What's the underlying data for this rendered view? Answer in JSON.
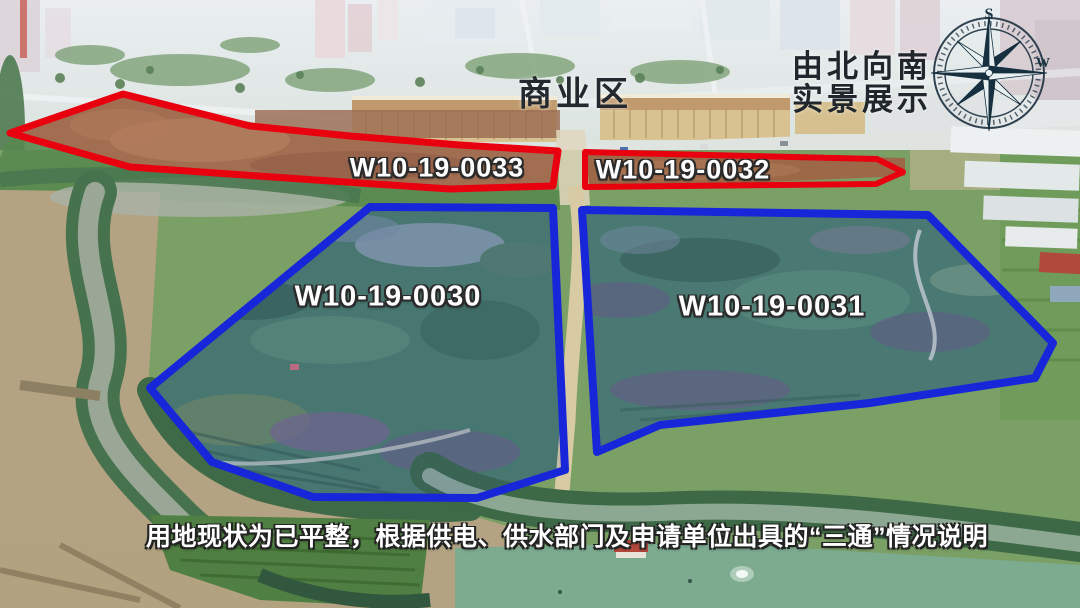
{
  "scene": {
    "type": "annotated-aerial-photo",
    "zone_label": "商业区",
    "view_label_line1": "由北向南",
    "view_label_line2": "实景展示",
    "caption": "用地现状为已平整，根据供电、供水部门及申请单位出具的“三通”情况说明"
  },
  "parcels": [
    {
      "id": "W10-19-0033",
      "outline": "red"
    },
    {
      "id": "W10-19-0032",
      "outline": "red"
    },
    {
      "id": "W10-19-0030",
      "outline": "blue"
    },
    {
      "id": "W10-19-0031",
      "outline": "blue"
    }
  ],
  "compass": {
    "top_letter": "S",
    "right_letter": "W"
  },
  "colors": {
    "outline_red": "#e8000f",
    "outline_blue": "#1726d8",
    "parcel_label_text": "#ffffff",
    "heading_text": "#23292e",
    "caption_text": "#ffffff"
  }
}
